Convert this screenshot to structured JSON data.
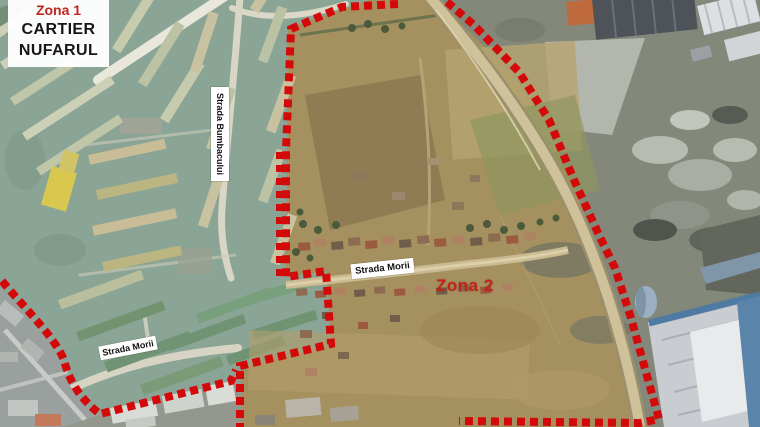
{
  "labels": {
    "zone1": "Zona 1",
    "district_line1": "CARTIER",
    "district_line2": "NUFARUL",
    "zone2": "Zona 2",
    "street_bumbacului": "Strada Bumbacului",
    "street_morii_central": "Strada Morii",
    "street_morii_west": "Strada Morii"
  },
  "colors": {
    "boundary_red": "#d40909",
    "zone_label_red": "#c0241c",
    "label_background": "#ffffff",
    "label_text": "#111111",
    "residential_tint": "#8aa495",
    "farmland": "#a5915f",
    "scrubland": "#83887b"
  }
}
